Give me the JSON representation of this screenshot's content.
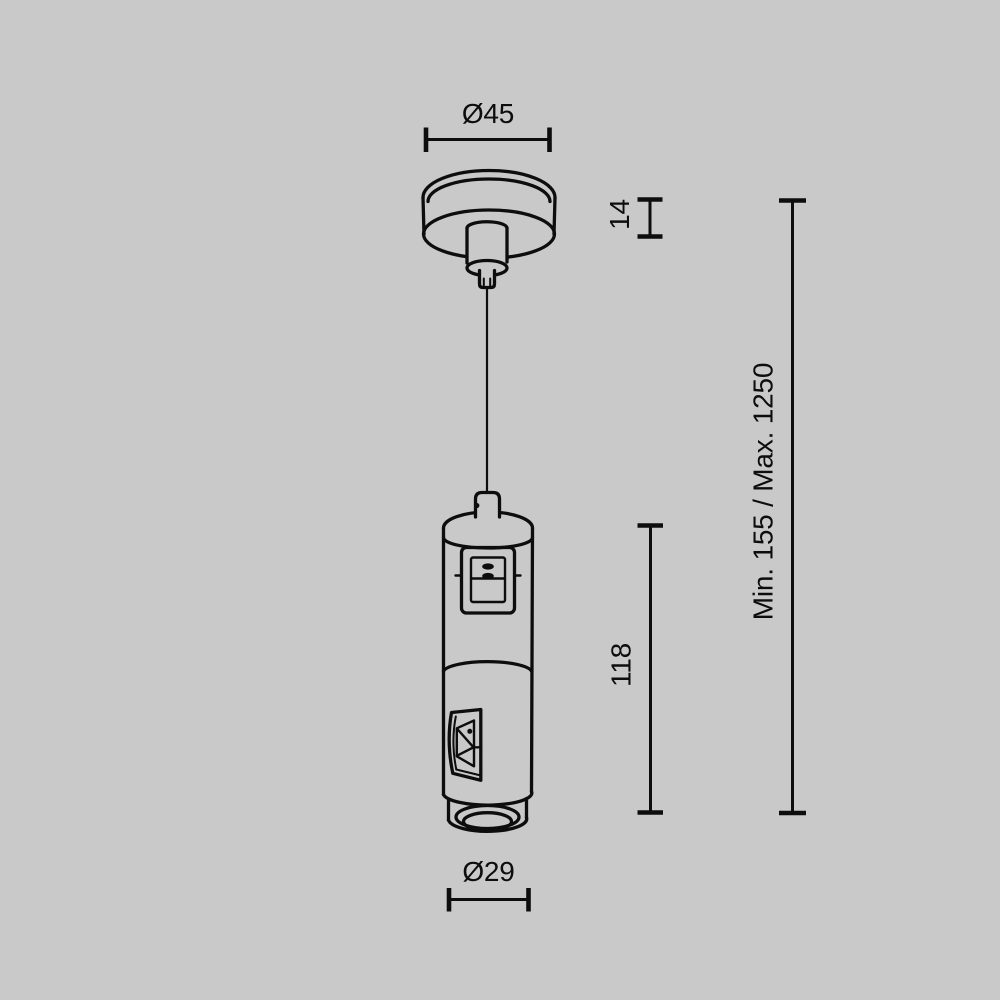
{
  "page": {
    "background_color": "#c9c9c9",
    "line_color": "#0d0d0d"
  },
  "dimensions": {
    "canopy_diameter": {
      "label": "Ø45",
      "value": 45
    },
    "canopy_height": {
      "label": "14",
      "value": 14
    },
    "body_length": {
      "label": "118",
      "value": 118
    },
    "suspension_length": {
      "label": "Min. 155 / Max. 1250",
      "min": 155,
      "max": 1250
    },
    "body_diameter": {
      "label": "Ø29",
      "value": 29
    }
  }
}
